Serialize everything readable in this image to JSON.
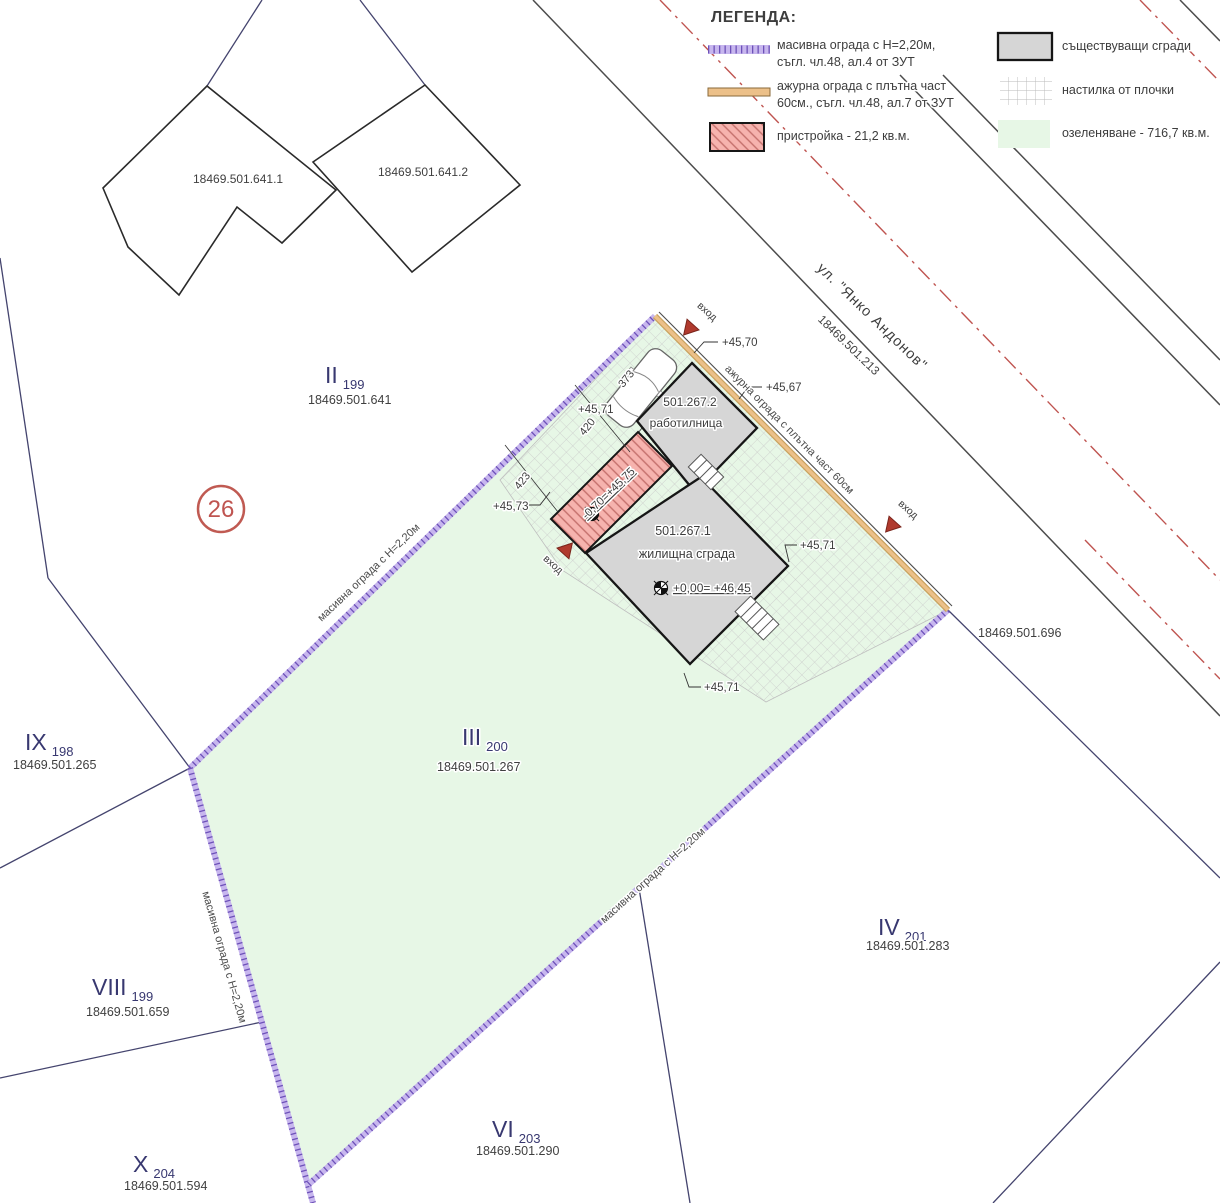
{
  "legend": {
    "title": "ЛЕГЕНДА:",
    "items": [
      {
        "line1": "масивна ограда с Н=2,20м,",
        "line2": "съгл. чл.48, ал.4 от ЗУТ"
      },
      {
        "line1": "ажурна ограда с плътна част",
        "line2": "60см., съгл. чл.48, ал.7 от ЗУТ"
      },
      {
        "line1": "пристройка - 21,2 кв.м."
      },
      {
        "line1": "съществуващи сгради"
      },
      {
        "line1": "настилка от плочки"
      },
      {
        "line1": "озеленяване - 716,7 кв.м."
      }
    ]
  },
  "street": {
    "name": "ул. \"Янко Андонов\"",
    "id": "18469.501.213"
  },
  "parcels": {
    "p2": {
      "roman": "II",
      "num": "199",
      "id": "18469.501.641"
    },
    "p3": {
      "roman": "III",
      "num": "200",
      "id": "18469.501.267"
    },
    "p4": {
      "roman": "IV",
      "num": "201",
      "id": "18469.501.283"
    },
    "p6": {
      "roman": "VI",
      "num": "203",
      "id": "18469.501.290"
    },
    "p8": {
      "roman": "VIII",
      "num": "199",
      "id": "18469.501.659"
    },
    "p9": {
      "roman": "IX",
      "num": "198",
      "id": "18469.501.265"
    },
    "p10": {
      "roman": "X",
      "num": "204",
      "id": "18469.501.594"
    },
    "neighbor_id": "18469.501.696"
  },
  "buildings": {
    "n1": "18469.501.641.1",
    "n2": "18469.501.641.2",
    "workshop": {
      "id": "501.267.2",
      "name": "работилница"
    },
    "house": {
      "id": "501.267.1",
      "name": "жилищна сграда"
    }
  },
  "levels": {
    "l1": "+45,70",
    "l2": "+45,67",
    "l3": "+45,71",
    "l4": "+45,73",
    "annex": "-0,70=+45,75",
    "main": "+0,00= +46,45"
  },
  "dims": {
    "car": "373",
    "d1": "420",
    "d2": "423"
  },
  "fences": {
    "solid": "масивна ограда с Н=2,20м",
    "openwork": "ажурна ограда с плътна част 60см"
  },
  "marks": {
    "entrance": "вход",
    "plot": "26"
  },
  "colors": {
    "greening": "#e7f7e6",
    "building_gray": "#d6d6d6",
    "annex_red": "#f6b3ae",
    "fence_purple": "#b49de0",
    "fence_orange": "#ecc089",
    "navy": "#383870",
    "street_red": "#bf5450"
  }
}
